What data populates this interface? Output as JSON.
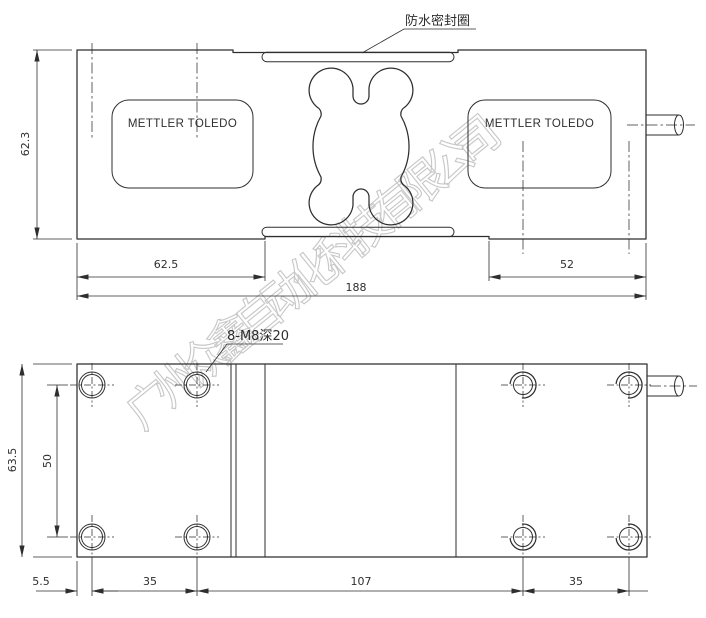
{
  "watermark": "广州众鑫自动化科技有限公司",
  "brand": "METTLER TOLEDO",
  "top_view": {
    "seal_callout": "防水密封圈",
    "dim_height": "62.3",
    "dim_left_section": "62.5",
    "dim_total": "188",
    "dim_right_section": "52"
  },
  "bottom_view": {
    "holes_callout": "8-M8深20",
    "dim_height": "63.5",
    "dim_rows": "50",
    "dim_edge": "5.5",
    "dim_left": "35",
    "dim_center": "107",
    "dim_right": "35"
  },
  "colors": {
    "line": "#2e2e2e",
    "watermark": "#a8a8a8",
    "background": "#ffffff"
  }
}
